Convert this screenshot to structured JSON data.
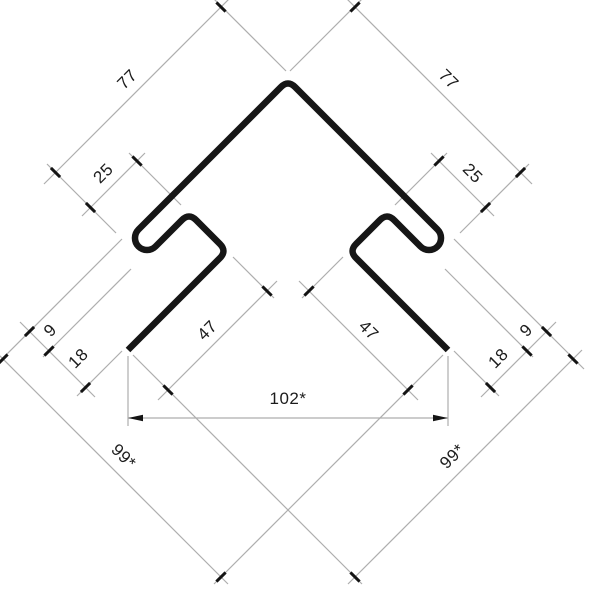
{
  "drawing": {
    "title": "corner-profile-cross-section",
    "labels": {
      "len_left": "77",
      "len_right": "77",
      "hook_left": "25",
      "hook_right": "25",
      "leg_left": "47",
      "leg_right": "47",
      "depth9_left": "9",
      "depth18_left": "18",
      "depth9_right": "9",
      "depth18_right": "18",
      "face_left": "99*",
      "face_right": "99*",
      "width_total": "102*"
    },
    "colors": {
      "profile": "#161616",
      "dim_line": "#aeaeae",
      "tick": "#141414",
      "text": "#1c1c1c",
      "background": "#ffffff"
    }
  }
}
